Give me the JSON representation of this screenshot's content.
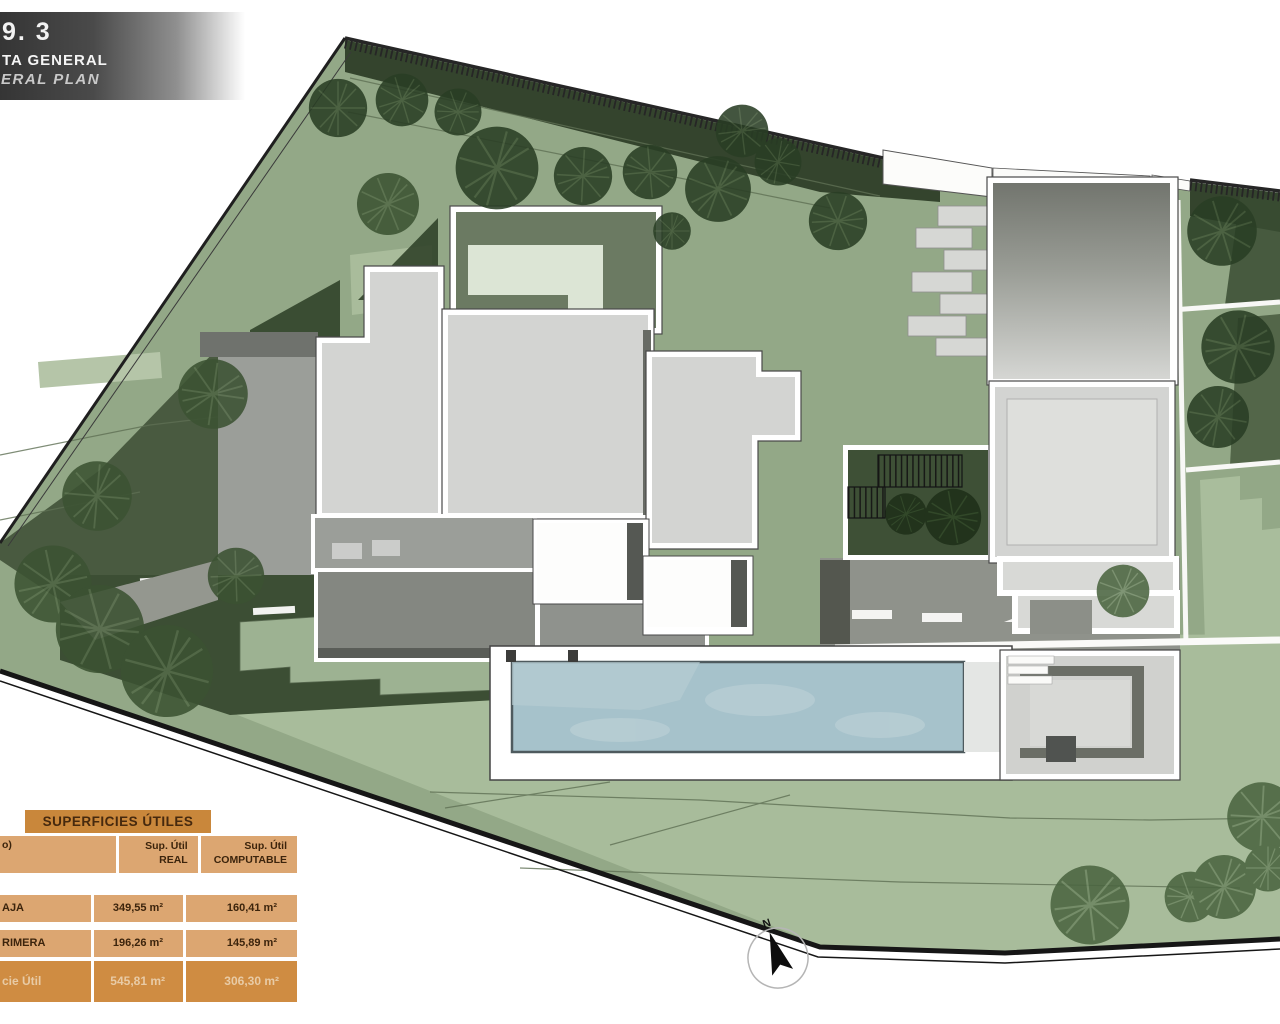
{
  "title_block": {
    "sheet_number": "9. 3",
    "title_es": "TA GENERAL",
    "title_en": "ERAL PLAN"
  },
  "areas_table": {
    "title": "SUPERFICIES ÚTILES",
    "col1_header": "o)",
    "col2_header_line1": "Sup. Útil",
    "col2_header_line2": "REAL",
    "col3_header_line1": "Sup. Útil",
    "col3_header_line2": "COMPUTABLE",
    "rows": [
      {
        "label": "AJA",
        "real": "349,55 m²",
        "computable": "160,41 m²"
      },
      {
        "label": "RIMERA",
        "real": "196,26 m²",
        "computable": "145,89 m²"
      }
    ],
    "total_row": {
      "label": "cie Útil",
      "real": "545,81 m²",
      "computable": "306,30 m²"
    }
  },
  "compass": {
    "north_label": "N"
  },
  "colors": {
    "table_header_bg": "#c9873b",
    "table_row_bg": "#dca671",
    "table_total_bg": "#cf8c42",
    "table_text": "#3c240c",
    "table_total_text": "#e8cba6",
    "site_green": "#93a887",
    "lawn_green": "#a8bc9b",
    "dark_green": "#3c4e34",
    "tree_green": "#2a3e25",
    "pool_water": "#a6c2cb",
    "building_gray": "#d3d4d2",
    "boundary_black": "#1f1f1f"
  }
}
